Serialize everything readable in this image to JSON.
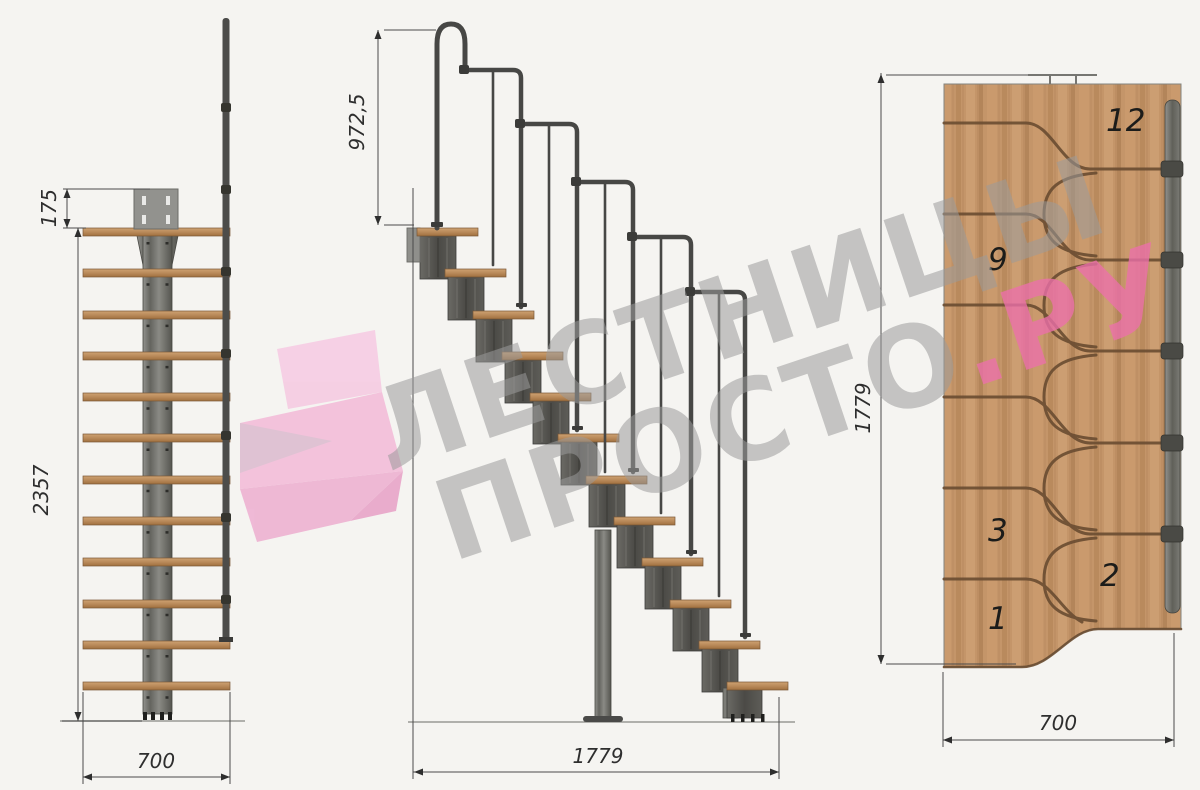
{
  "watermark": {
    "line1": "ЛЕСТНИЦЫ",
    "line2_gray": "ПРОСТО",
    "line2_pink": ".РУ"
  },
  "front_view": {
    "dim_plate_offset": "175",
    "dim_total_height": "2357",
    "dim_width": "700"
  },
  "side_view": {
    "dim_handrail_height": "972,5",
    "dim_total_length": "1779"
  },
  "plan_view": {
    "dim_total_length": "1779",
    "dim_width": "700",
    "step_labels": [
      "12",
      "9",
      "3",
      "2",
      "1"
    ]
  },
  "colors": {
    "background": "#f5f4f1",
    "wood": "#c49569",
    "steel": "#4c4c4a",
    "dimension_lines": "#4a4a4a",
    "groove_brown": "#6a4c31",
    "watermark_gray": "#9b9b9b",
    "watermark_pink": "#ec6fab",
    "logo_pink": "#f3bcd9"
  }
}
